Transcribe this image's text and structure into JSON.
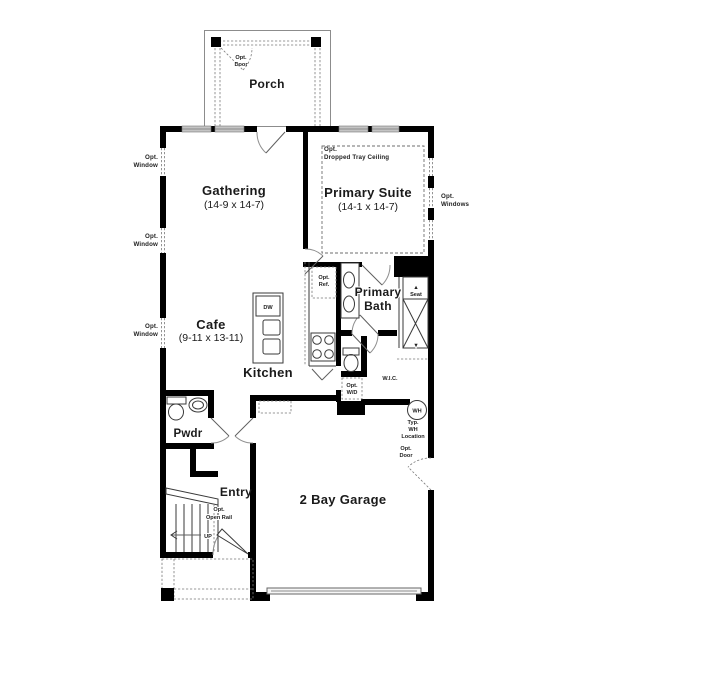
{
  "rooms": {
    "porch": {
      "name": "Porch"
    },
    "gathering": {
      "name": "Gathering",
      "dims": "(14-9 x 14-7)"
    },
    "primary_suite": {
      "name": "Primary Suite",
      "dims": "(14-1 x 14-7)"
    },
    "primary_bath": {
      "line1": "Primary",
      "line2": "Bath"
    },
    "cafe": {
      "name": "Cafe",
      "dims": "(9-11 x 13-11)"
    },
    "kitchen": {
      "name": "Kitchen"
    },
    "pwdr": {
      "name": "Pwdr"
    },
    "entry": {
      "name": "Entry"
    },
    "wic": {
      "name": "W.I.C."
    },
    "garage": {
      "name": "2 Bay Garage"
    }
  },
  "annotations": {
    "opt_door": {
      "line1": "Opt.",
      "line2": "Door"
    },
    "opt_window": {
      "line1": "Opt.",
      "line2": "Window"
    },
    "opt_windows": {
      "line1": "Opt.",
      "line2": "Windows"
    },
    "tray_ceiling": {
      "line1": "Opt.",
      "line2": "Dropped Tray Ceiling"
    },
    "opt_ref": {
      "line1": "Opt.",
      "line2": "Ref."
    },
    "opt_wd": {
      "line1": "Opt.",
      "line2": "W/D"
    },
    "open_rail": {
      "line1": "Opt.",
      "line2": "Open Rail"
    },
    "wh_location": {
      "line1": "Typ.",
      "line2": "WH",
      "line3": "Location"
    },
    "seat": {
      "label": "Seat"
    },
    "dw": {
      "label": "DW"
    },
    "wh": {
      "label": "WH"
    },
    "up": {
      "label": "UP"
    }
  },
  "markers": {
    "up_triangle": "▲",
    "down_triangle": "▼"
  },
  "colors": {
    "background": "#ffffff",
    "wall": "#000000",
    "window_fill": "#c4c4c4",
    "ink": "#1a1a1a"
  }
}
